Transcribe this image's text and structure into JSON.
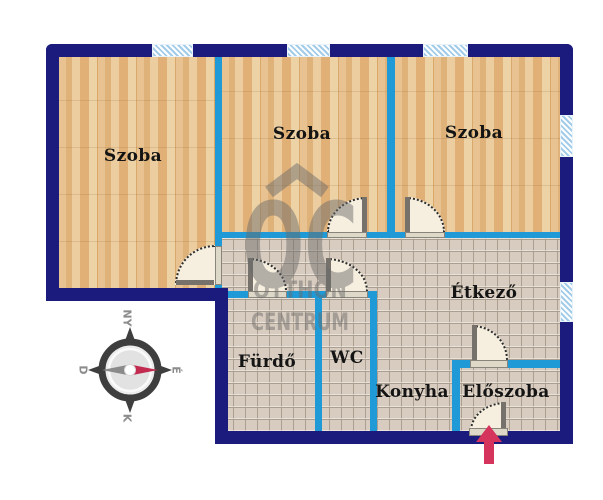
{
  "floorplan": {
    "rooms": [
      {
        "id": "szoba-left",
        "label": "Szoba"
      },
      {
        "id": "szoba-middle",
        "label": "Szoba"
      },
      {
        "id": "szoba-right",
        "label": "Szoba"
      },
      {
        "id": "etkezo",
        "label": "Étkező"
      },
      {
        "id": "furdo",
        "label": "Fürdő"
      },
      {
        "id": "wc",
        "label": "WC"
      },
      {
        "id": "konyha",
        "label": "Konyha"
      },
      {
        "id": "eloszoba",
        "label": "Előszoba"
      }
    ],
    "compass": {
      "top": "NY",
      "right": "É",
      "bottom": "K",
      "left": "D"
    },
    "watermark": {
      "logo": "OC",
      "line1": "OTTHON",
      "line2": "CENTRUM"
    },
    "colors": {
      "outer_wall": "#1b1b7e",
      "inner_wall": "#1f9ad6",
      "window_blue": "#a3cce9",
      "wood_floor": "#e3bb85",
      "tile_floor": "#d7ccbf",
      "door_fill": "#f6efdf",
      "entry_arrow": "#d5355c",
      "compass_needle_red": "#c22a50",
      "compass_needle_gray": "#8a8a8a"
    }
  }
}
